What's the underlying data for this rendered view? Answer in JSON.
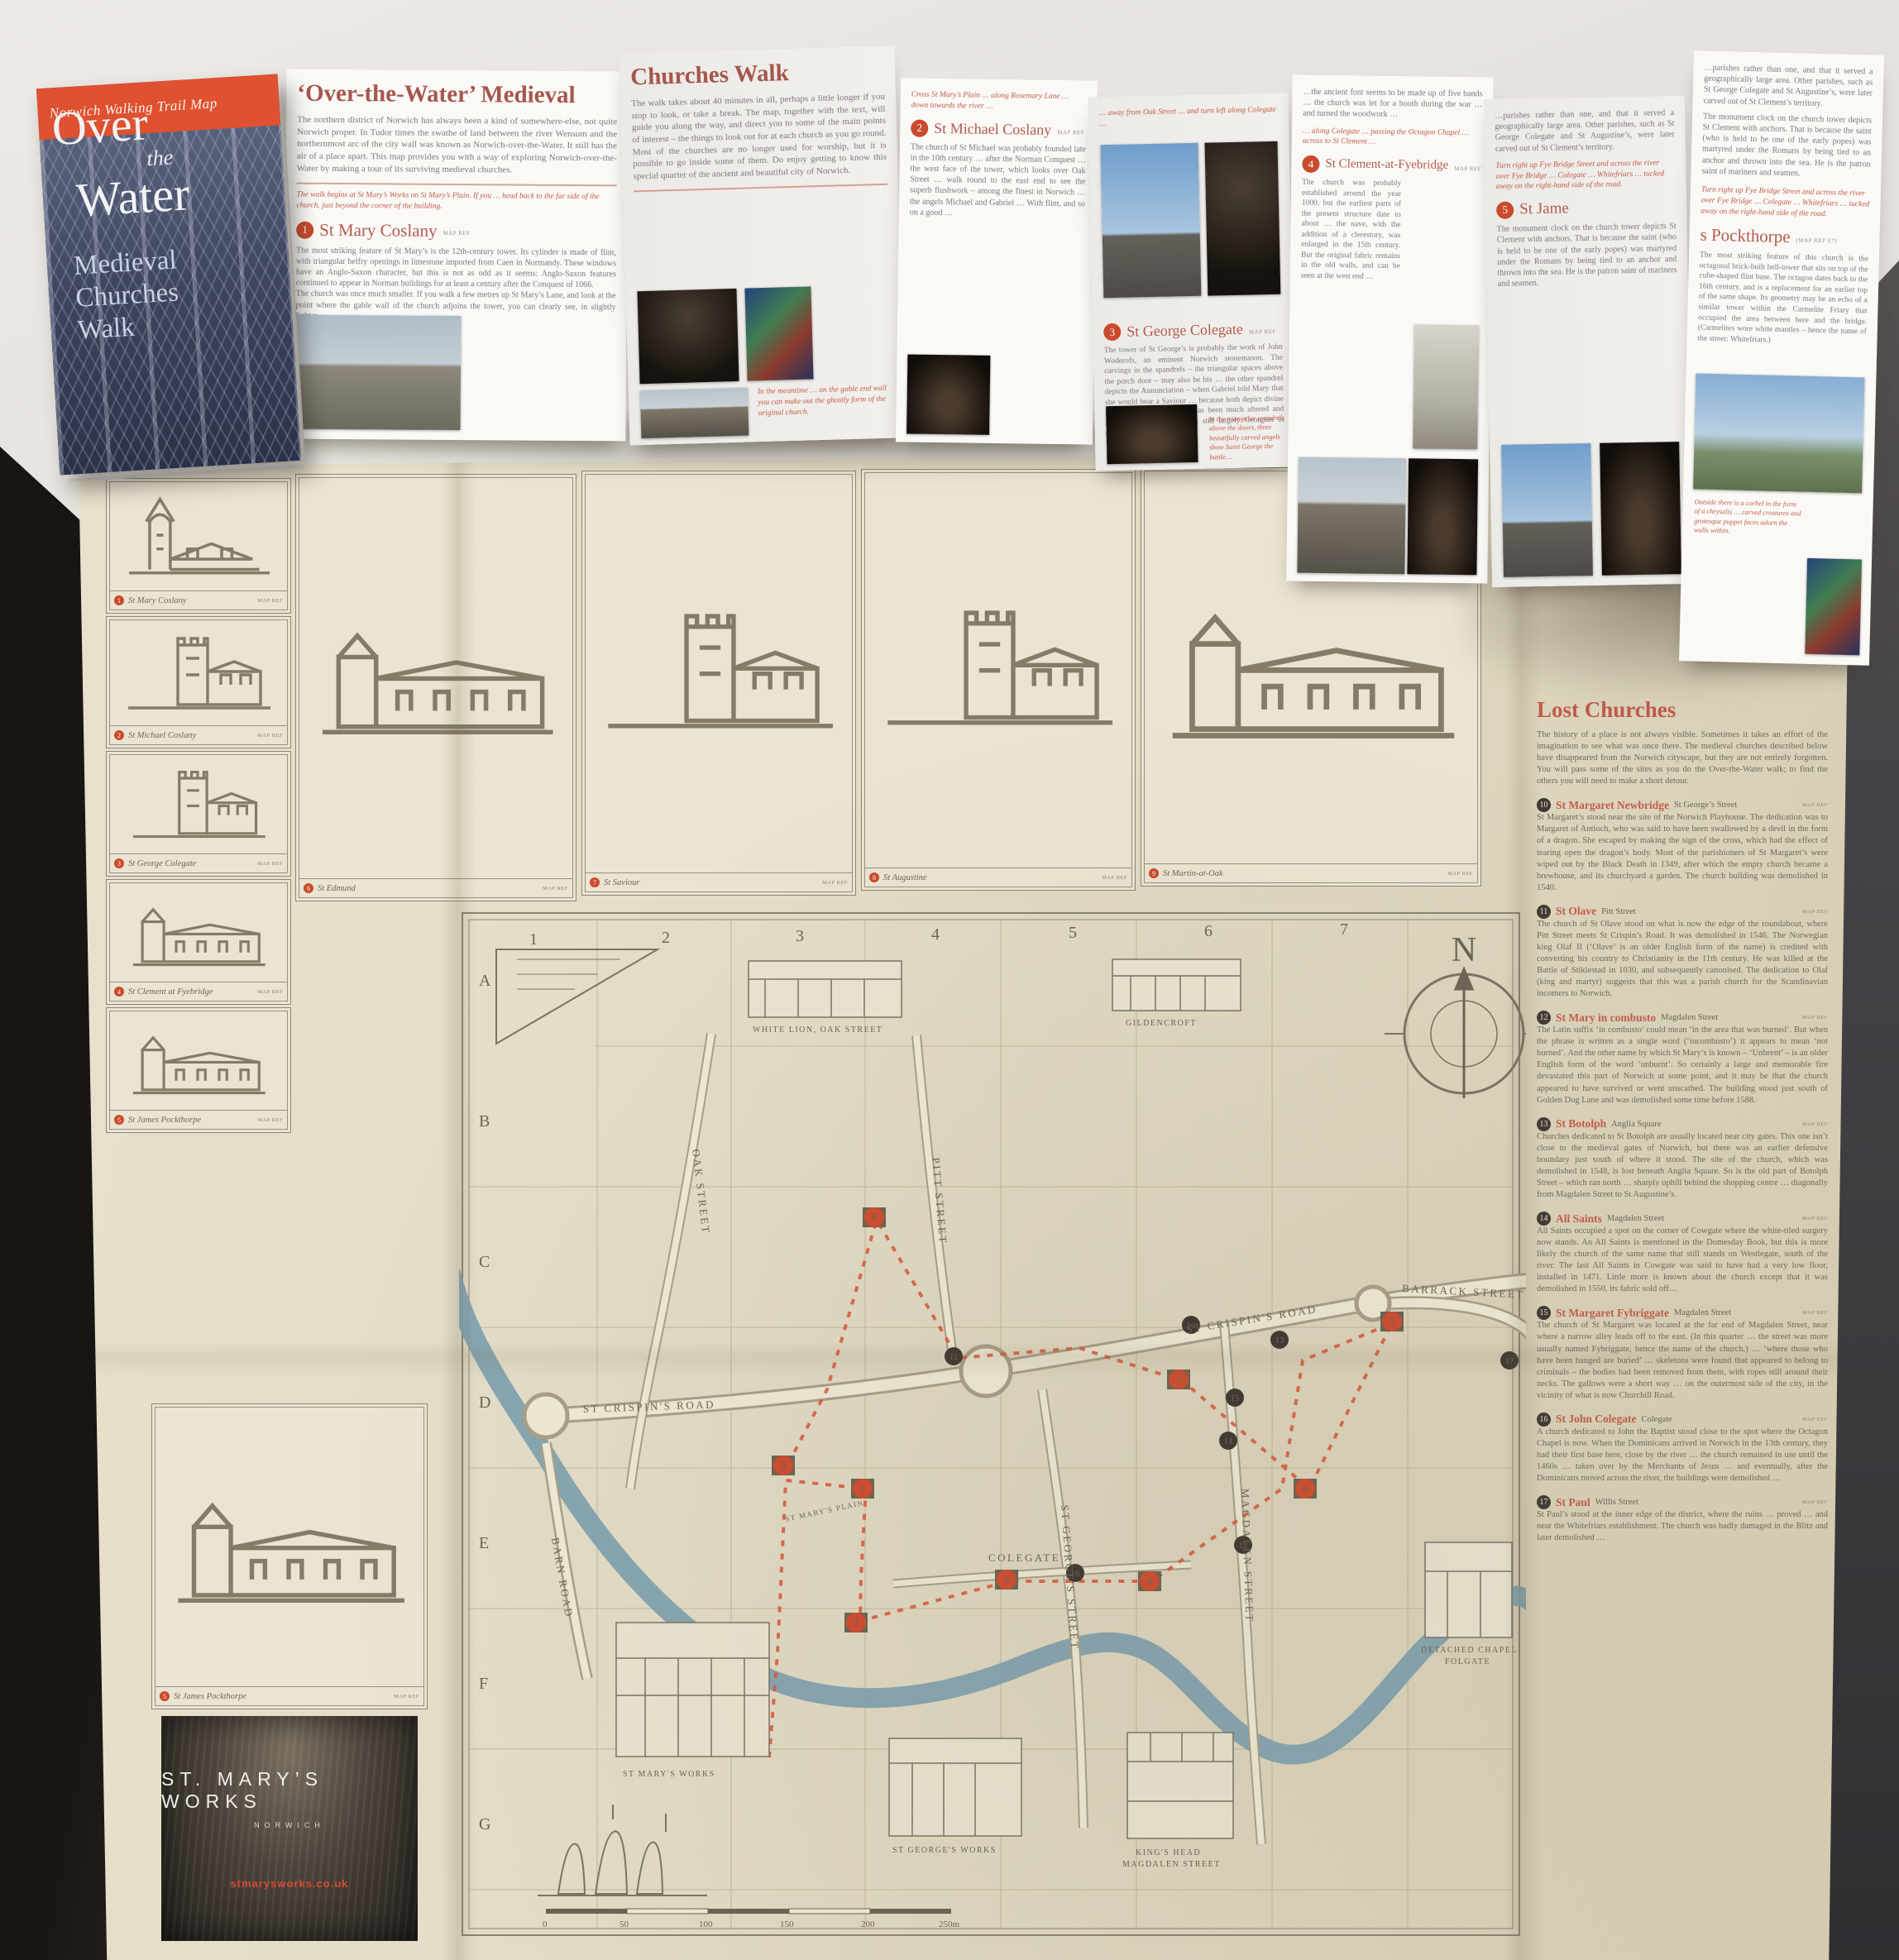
{
  "cover": {
    "banner": "Norwich Walking Trail Map",
    "title_1": "Over",
    "title_2": "the",
    "title_3": "Water",
    "subtitle_1": "Medieval",
    "subtitle_2": "Churches",
    "subtitle_3": "Walk"
  },
  "brochure": {
    "heading_1": "‘Over-the-Water’ Medieval",
    "heading_2": "Churches Walk",
    "intro_1": "The northern district of Norwich has always been a kind of somewhere-else, not quite Norwich proper. In Tudor times the swathe of land between the river Wensum and the northernmost arc of the city wall was known as Norwich-over-the-Water. It still has the air of a place apart. This map provides you with a way of exploring Norwich-over-the-Water by making a tour of its surviving medieval churches.",
    "intro_2": "The walk takes about 40 minutes in all, perhaps a little longer if you stop to look, or take a break. The map, together with the text, will guide you along the way, and direct you to some of the main points of interest – the things to look out for at each church as you go round. Most of the churches are no longer used for worship, but it is possible to go inside some of them. Do enjoy getting to know this special quarter of the ancient and beautiful city of Norwich.",
    "walk_note": "The walk begins at St Mary’s Works on St Mary’s Plain. If you … head back to the far side of the church, just beyond the corner of the building.",
    "sections": [
      {
        "num": "1",
        "name": "St Mary Coslany",
        "map_ref": "MAP REF",
        "body": "The most striking feature of St Mary’s is the 12th-century tower. Its cylinder is made of flint, with triangular belfry openings in limestone imported from Caen in Normandy. These windows have an Anglo-Saxon character, but this is not as odd as it seems: Anglo-Saxon features continued to appear in Norman buildings for at least a century after the Conquest of 1066.\nThe church was once much smaller. If you walk a few metres up St Mary’s Lane, and look at the point where the gable wall of the church adjoins the tower, you can clearly see, in slightly lighter…"
      },
      {
        "num": "2",
        "name": "St Michael Coslany",
        "map_ref": "MAP REF",
        "directions": "Cross St Mary’s Plain … along Rosemary Lane … down towards the river …",
        "body": "The church of St Michael was probably founded late in the 10th century … after the Norman Conquest … the west face of the tower, which looks over Oak Street … walk round to the east end to see the superb flushwork – among the finest in Norwich … the angels Michael and Gabriel … With flint, and so on a good …"
      },
      {
        "num": "3",
        "name": "St George Colegate",
        "map_ref": "MAP REF",
        "directions": "… away from Oak Street … and turn left along Colegate …",
        "body": "The tower of St George’s is probably the work of John Woderofs, an eminent Norwich stonemason. The carvings in the spandrels – the triangular spaces above the porch door – may also be his … the other spandrel depicts the Annunciation – when Gabriel told Mary that she would bear a Saviour … because both depict divine individuals … the church has been much altered and restored, but the interior is still largely Georgian in character …"
      },
      {
        "num": "4",
        "name": "St Clement-at-Fyebridge",
        "map_ref": "MAP REF",
        "directions": "… along Colegate … passing the Octagon Chapel … across to St Clement …",
        "body": "The church was probably established around the year 1000, but the earliest parts of the present structure date to about … the nave, with the addition of a clerestory, was enlarged in the 15th century. But the original fabric remains in the old walls, and can be seen at the west end …"
      },
      {
        "num": "5",
        "name_a": "St Jame",
        "name_b": "s Pockthorpe",
        "map_ref": "(MAP REF E7)",
        "directions": "Turn right up Fye Bridge Street and across the river over Fye Bridge … Colegate … Whitefriars … tucked away on the right-hand side of the road.",
        "body": "The most striking feature of this church is the octagonal brick-built bell-tower that sits on top of the cube-shaped flint base. The octagon dates back to the 16th century, and is a replacement for an earlier top of the same shape. Its geometry may be an echo of a similar tower within the Carmelite Friary that occupied the area between here and the bridge. (Carmelites wore white mantles – hence the name of the street: Whitefriars.)"
      }
    ],
    "photo_note_1": "In the meantime … on the gable end wall you can make out the ghostly form of the original church.",
    "photo_note_2": "In the triangular spandrels above the doors, three beautifully carved angels show Saint George the battle…",
    "photo_note_3": "Outside there is a corbel in the form of a chrysalis … carved creatures and grotesque puppet faces adorn the walls within.",
    "cont_1": "…the ancient font seems to be made up of five bands … the church was let for a booth during the war … and turned the woodwork …",
    "cont_2": "…parishes rather than one, and that it served a geographically large area. Other parishes, such as St George Colegate and St Augustine’s, were later carved out of St Clement’s territory.",
    "cont_3": "The monument clock on the church tower depicts St Clement with anchors. That is because the saint (who is held to be one of the early popes) was martyred under the Romans by being tied to an anchor and thrown into the sea. He is the patron saint of mariners and seamen."
  },
  "map_sheet": {
    "left_column": {
      "frames": [
        {
          "num": "1",
          "name": "St Mary Coslany",
          "map_ref": "MAP REF"
        },
        {
          "num": "2",
          "name": "St Michael Coslany",
          "map_ref": "MAP REF"
        },
        {
          "num": "3",
          "name": "St George Colegate",
          "map_ref": "MAP REF"
        },
        {
          "num": "4",
          "name": "St Clement at Fyebridge",
          "map_ref": "MAP REF"
        },
        {
          "num": "5",
          "name": "St James Pockthorpe",
          "map_ref": "MAP REF"
        }
      ],
      "feature": {
        "num": "5",
        "name": "St James Pockthorpe",
        "map_ref": "MAP REF"
      },
      "promo": {
        "title": "ST. MARY’S WORKS",
        "subtitle": "NORWICH",
        "url": "stmarysworks.co.uk"
      }
    },
    "top_row": [
      {
        "num": "6",
        "name": "St Edmund",
        "map_ref": "MAP REF"
      },
      {
        "num": "7",
        "name": "St Saviour",
        "map_ref": "MAP REF"
      },
      {
        "num": "8",
        "name": "St Augustine",
        "map_ref": "MAP REF"
      },
      {
        "num": "9",
        "name": "St Martin-at-Oak",
        "map_ref": "MAP REF"
      }
    ],
    "lost_churches": {
      "title": "Lost Churches",
      "intro": "The history of a place is not always visible. Sometimes it takes an effort of the imagination to see what was once there. The medieval churches described below have disappeared from the Norwich cityscape, but they are not entirely forgotten. You will pass some of the sites as you do the Over-the-Water walk; to find the others you will need to make a short detour.",
      "entries": [
        {
          "num": "10",
          "name": "St Margaret Newbridge",
          "loc": "St George’s Street",
          "map_ref": "MAP REF",
          "body": "St Margaret’s stood near the site of the Norwich Playhouse. The dedication was to Margaret of Antioch, who was said to have been swallowed by a devil in the form of a dragon. She escaped by making the sign of the cross, which had the effect of tearing open the dragon’s body. Most of the parishioners of St Margaret’s were wiped out by the Black Death in 1349, after which the empty church became a brewhouse, and its churchyard a garden. The church building was demolished in 1540."
        },
        {
          "num": "11",
          "name": "St Olave",
          "loc": "Pitt Street",
          "map_ref": "MAP REF",
          "body": "The church of St Olave stood on what is now the edge of the roundabout, where Pitt Street meets St Crispin’s Road. It was demolished in 1546. The Norwegian king Olaf II (‘Olave’ is an older English form of the name) is credited with converting his country to Christianity in the 11th century. He was killed at the Battle of Stiklestad in 1030, and subsequently canonised. The dedication to Olaf (king and martyr) suggests that this was a parish church for the Scandinavian incomers to Norwich."
        },
        {
          "num": "12",
          "name": "St Mary in combusto",
          "loc": "Magdalen Street",
          "map_ref": "MAP REF",
          "body": "The Latin suffix ‘in combusto’ could mean ‘in the area that was burned’. But when the phrase is written as a single word (‘incombusto’) it appears to mean ‘not burned’. And the other name by which St Mary’s is known – ‘Unbrent’ – is an older English form of the word ‘unburnt’. So certainly a large and memorable fire devastated this part of Norwich at some point, and it may be that the church appeared to have survived or went unscathed. The building stood just south of Golden Dog Lane and was demolished some time before 1588."
        },
        {
          "num": "13",
          "name": "St Botolph",
          "loc": "Anglia Square",
          "map_ref": "MAP REF",
          "body": "Churches dedicated to St Botolph are usually located near city gates. This one isn’t close to the medieval gates of Norwich, but there was an earlier defensive boundary just south of where it stood. The site of the church, which was demolished in 1548, is lost beneath Anglia Square. So is the old part of Botolph Street – which ran north … sharply uphill behind the shopping centre … diagonally from Magdalen Street to St Augustine’s."
        },
        {
          "num": "14",
          "name": "All Saints",
          "loc": "Magdalen Street",
          "map_ref": "MAP REF",
          "body": "All Saints occupied a spot on the corner of Cowgate where the white-tiled surgery now stands. An All Saints is mentioned in the Domesday Book, but this is more likely the church of the same name that still stands on Westlegate, south of the river. The last All Saints in Cowgate was said to have had a very low floor, installed in 1471. Little more is known about the church except that it was demolished in 1550, its fabric sold off…"
        },
        {
          "num": "15",
          "name": "St Margaret Fybriggate",
          "loc": "Magdalen Street",
          "map_ref": "MAP REF",
          "body": "The church of St Margaret was located at the far end of Magdalen Street, near where a narrow alley leads off to the east. (In this quarter … the street was more usually named Fybriggate, hence the name of the church.) … ‘where those who have been hanged are buried’ … skeletons were found that appeared to belong to criminals – the bodies had been removed from them, with ropes still around their necks. The gallows were a short way … on the outermost side of the city, in the vicinity of what is now Churchill Road."
        },
        {
          "num": "16",
          "name": "St John Colegate",
          "loc": "Colegate",
          "map_ref": "MAP REF",
          "body": "A church dedicated to John the Baptist stood close to the spot where the Octagon Chapel is now. When the Dominicans arrived in Norwich in the 13th century, they had their first base here, close by the river … the church remained in use until the 1460s … taken over by the Merchants of Jesus … and eventually, after the Dominicans moved across the river, the buildings were demolished …"
        },
        {
          "num": "17",
          "name": "St Paul",
          "loc": "Willis Street",
          "map_ref": "MAP REF",
          "body": "St Paul’s stood at the inner edge of the district, where the ruins … proved … and near the Whitefriars establishment. The church was badly damaged in the Blitz and later demolished …"
        }
      ]
    },
    "map": {
      "cols": [
        "1",
        "2",
        "3",
        "4",
        "5",
        "6",
        "7"
      ],
      "rows": [
        "A",
        "B",
        "C",
        "D",
        "E",
        "F",
        "G"
      ],
      "compass": "N",
      "streets": {
        "crispins_1": "ST CRISPIN'S ROAD",
        "crispins_2": "ST CRISPIN'S ROAD",
        "barrack": "BARRACK STREET",
        "oak": "OAK STREET",
        "pitt": "PITT STREET",
        "st_georges": "ST GEORGE'S STREET",
        "magdalen": "MAGDALEN STREET",
        "colegate": "COLEGATE",
        "barn": "BARN ROAD",
        "plain": "ST MARY'S PLAIN",
        "gildencroft": "GILDENCROFT"
      },
      "captions": {
        "white_lion": "WHITE LION, OAK STREET",
        "gildencroft": "GILDENCROFT",
        "marys_works": "ST MARY'S WORKS",
        "georges_works": "ST GEORGE'S WORKS",
        "kings_head_1": "KING'S HEAD",
        "kings_head_2": "MAGDALEN STREET",
        "chapel_1": "DETACHED CHAPEL",
        "chapel_2": "FOLGATE"
      },
      "scale": [
        "0",
        "50",
        "100",
        "150",
        "200",
        "250m"
      ],
      "badges_red": [
        "1",
        "2",
        "3",
        "4",
        "5",
        "6",
        "7",
        "8",
        "9"
      ],
      "badges_dark": [
        "10",
        "11",
        "12",
        "13",
        "14",
        "15",
        "16",
        "17"
      ]
    }
  }
}
